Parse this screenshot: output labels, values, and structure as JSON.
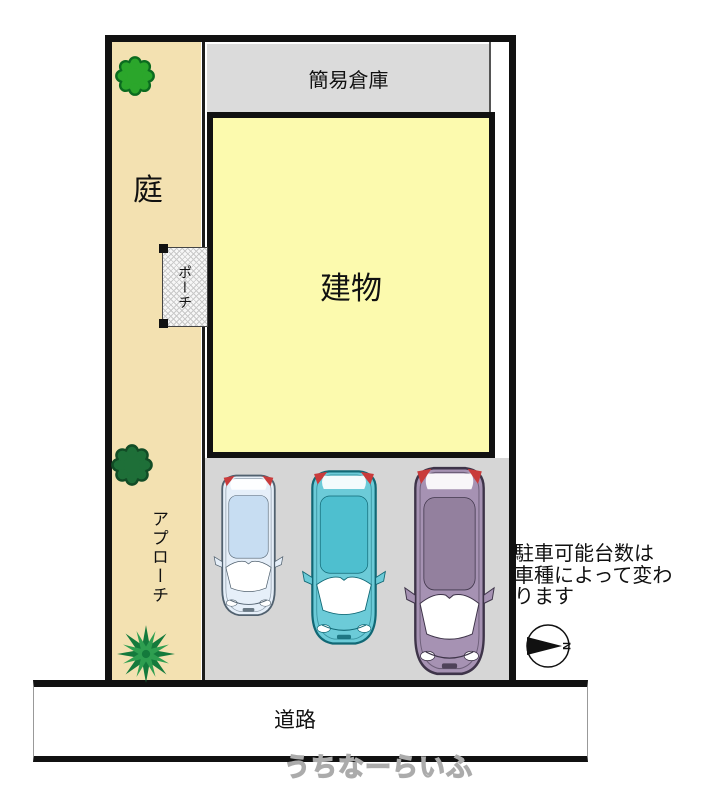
{
  "plan": {
    "garden_label": "庭",
    "storage_label": "簡易倉庫",
    "building_label": "建物",
    "porch_label": "ポーチ",
    "approach_label": "アプローチ",
    "road_label": "道路",
    "parking_note_lines": [
      "駐車可能台数は",
      "車種によって変わ",
      "ります"
    ],
    "compass_letter": "N",
    "watermark": "うちなーらいふ",
    "colors": {
      "garden": "#F3E1B1",
      "building": "#FCFAAE",
      "storage": "#DBDBDB",
      "parking": "#D6D6D6",
      "taillight": "#C93B3B",
      "tree": "#2BA62B",
      "tree_outline": "#0B6B1F",
      "bush": "#1E6F38",
      "bush_outline": "#124C26",
      "palm": "#2E9E50",
      "palm_dark": "#147A3C"
    },
    "cars": [
      {
        "name": "compact car",
        "body_color": "#E6EFF9",
        "roof_color": "#C7DDF2",
        "outline_color": "#51616F"
      },
      {
        "name": "hatchback",
        "body_color": "#6CCBD8",
        "roof_color": "#4EBFCF",
        "outline_color": "#116875"
      },
      {
        "name": "minivan",
        "body_color": "#A692B3",
        "roof_color": "#93809E",
        "outline_color": "#3E3449"
      }
    ]
  }
}
